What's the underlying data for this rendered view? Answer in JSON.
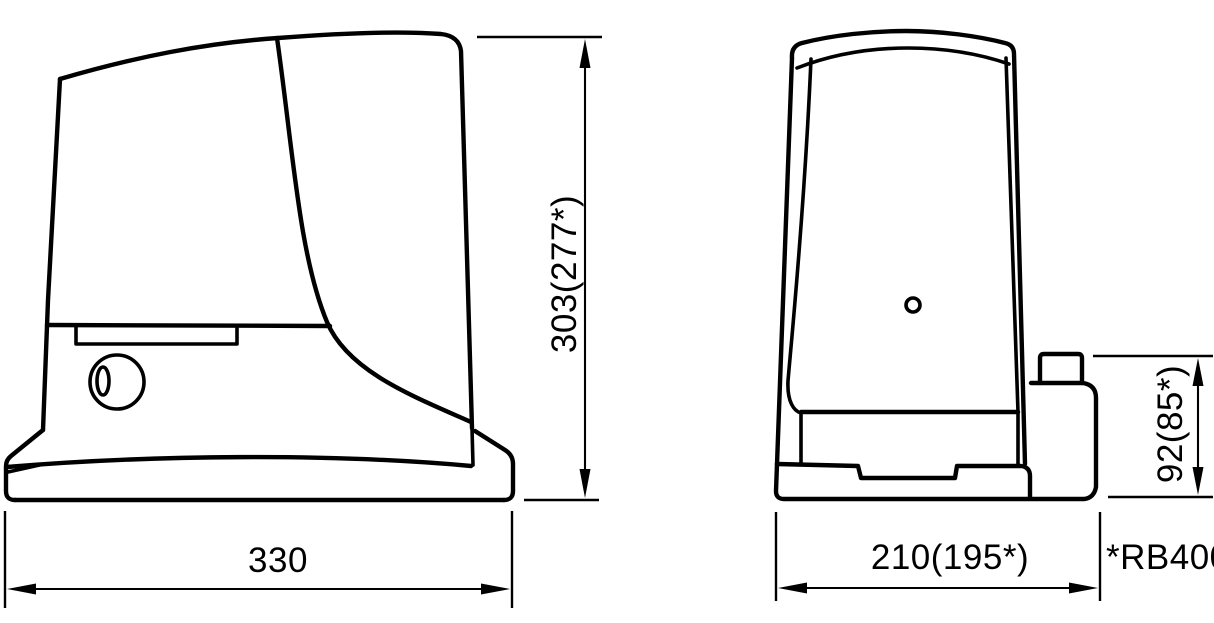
{
  "diagram": {
    "title": "Gate motor dimensional drawing",
    "line_color": "#000000",
    "background_color": "#ffffff",
    "side_view": {
      "width_label": "330",
      "height_label": "303(277*)"
    },
    "front_view": {
      "depth_label": "210(195*)",
      "pinion_height_label": "92(85*)"
    },
    "footnote": "*RB400"
  }
}
